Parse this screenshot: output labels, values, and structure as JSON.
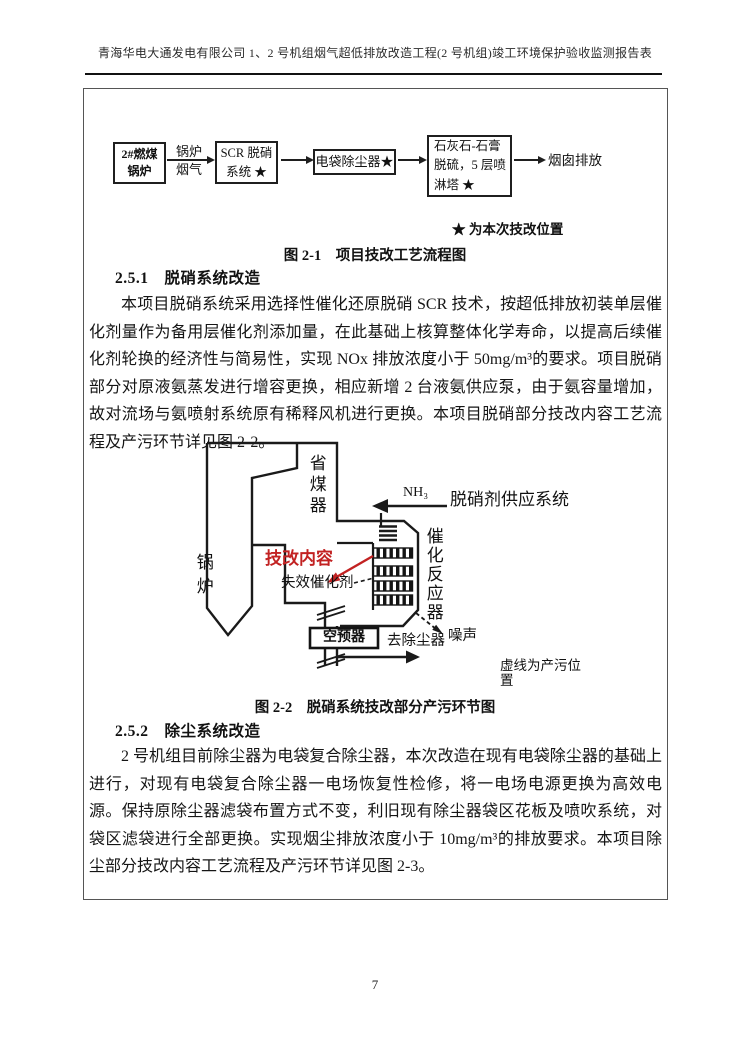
{
  "header": {
    "title": "青海华电大通发电有限公司 1、2 号机组烟气超低排放改造工程(2 号机组)竣工环境保护验收监测报告表"
  },
  "flowchart": {
    "box_boiler": "2#燃煤\n锅炉",
    "arrow_label_flue_gas": "锅炉\n烟气",
    "box_scr": "SCR 脱硝\n系统 ★",
    "box_esp": "电袋除尘器★",
    "box_fgd": "石灰石-石膏\n脱硫，5 层喷\n淋塔 ★",
    "outlet_label": "烟囱排放",
    "legend": "★ 为本次技改位置"
  },
  "figure1": {
    "caption": "图 2-1　项目技改工艺流程图"
  },
  "section1": {
    "heading": "2.5.1　脱硝系统改造",
    "paragraph": "本项目脱硝系统采用选择性催化还原脱硝 SCR 技术，按超低排放初装单层催化剂量作为备用层催化剂添加量，在此基础上核算整体化学寿命，以提高后续催化剂轮换的经济性与简易性，实现 NOx 排放浓度小于 50mg/m³的要求。项目脱硝部分对原液氨蒸发进行增容更换，相应新增 2 台液氨供应泵，由于氨容量增加，故对流场与氨喷射系统原有稀释风机进行更换。本项目脱硝部分技改内容工艺流程及产污环节详见图 2-2。"
  },
  "diagram": {
    "boiler": "锅炉",
    "economizer": "省煤器",
    "nh3": "NH₃",
    "supply_system": "脱硝剂供应系统",
    "modification": "技改内容",
    "spent_catalyst": "失效催化剂",
    "reactor": "催化反应器",
    "air_preheater": "空预器",
    "to_dust_collector": "去除尘器",
    "noise": "噪声",
    "note": "虚线为产污位置"
  },
  "figure2": {
    "caption": "图 2-2　脱硝系统技改部分产污环节图"
  },
  "section2": {
    "heading": "2.5.2　除尘系统改造",
    "paragraph": "2 号机组目前除尘器为电袋复合除尘器，本次改造在现有电袋除尘器的基础上进行，对现有电袋复合除尘器一电场恢复性检修，将一电场电源更换为高效电源。保持原除尘器滤袋布置方式不变，利旧现有除尘器袋区花板及喷吹系统，对袋区滤袋进行全部更换。实现烟尘排放浓度小于 10mg/m³的排放要求。本项目除尘部分技改内容工艺流程及产污环节详见图 2-3。"
  },
  "footer": {
    "page_number": "7"
  }
}
